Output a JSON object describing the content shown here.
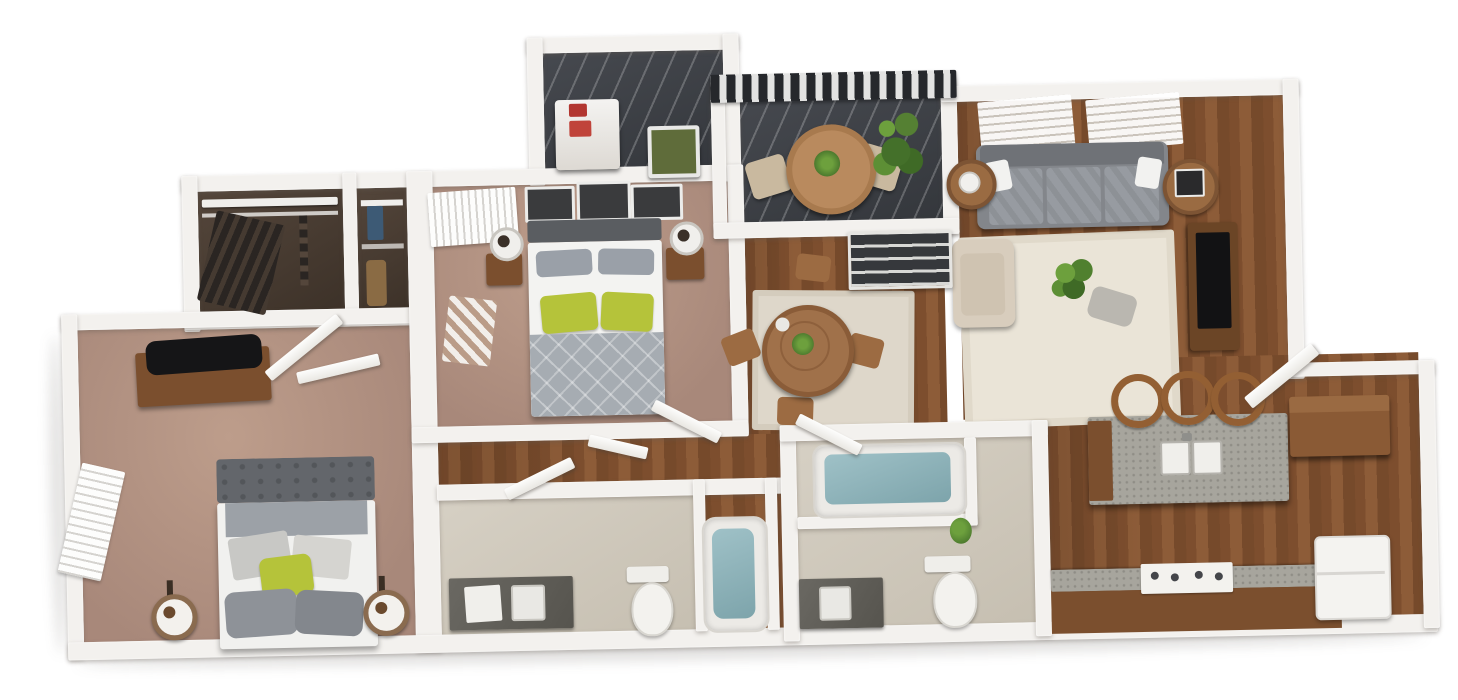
{
  "scene": {
    "kind": "3d-rendered-floor-plan",
    "description": "Top-down 3D rendering of a two-bedroom, two-bathroom apartment with balcony, open kitchen, dining and living areas",
    "background_color": "#ffffff",
    "visible_text": [],
    "bedrooms": 2,
    "bathrooms": 2
  },
  "palette": {
    "wall_white": "#f3f1ee",
    "carpet_mauve": "#b3927f",
    "wood_floor_brown": "#7f5130",
    "dark_floor_charcoal": "#3e4146",
    "bathroom_floor_beige": "#d0c9bc",
    "rug_cream": "#eae4d7",
    "sofa_gray": "#8e9196",
    "blanket_gray": "#a6acb2",
    "accent_pillow_green": "#b5c33a",
    "tub_water_teal": "#8fb3ba",
    "cabinet_brown": "#7b4f2e",
    "granite_gray": "#a7a59d",
    "railing_stripe_dark": "#26282c"
  },
  "rooms": {
    "balcony": {
      "name": "balcony",
      "floor": "dark charcoal decking",
      "furniture": [
        "striped railing",
        "round bistro table",
        "patio chair left",
        "patio chair right",
        "potted plant",
        "table plant"
      ]
    },
    "laundry_closet": {
      "name": "laundry closet",
      "floor": "dark charcoal",
      "furniture": [
        "washer-dryer unit",
        "red detergent bottles",
        "framed wall art"
      ]
    },
    "living_room": {
      "name": "living room",
      "floor": "hardwood",
      "furniture": [
        "gray sofa",
        "white throw pillows",
        "round side table with lamp",
        "round side table with dark lamp",
        "tv console",
        "flat screen tv",
        "cream area rug",
        "beige armchair",
        "potted centerpiece plant",
        "gray throw"
      ]
    },
    "dining_area": {
      "name": "dining area",
      "floor": "hardwood",
      "furniture": [
        "round dining table",
        "dining chair x4",
        "centerpiece plant",
        "area rug",
        "pantry shelves"
      ]
    },
    "master_bedroom": {
      "name": "master bedroom",
      "floor": "mauve carpet",
      "furniture": [
        "queen bed with green accent pillows",
        "nightstand left",
        "nightstand right",
        "table lamp left",
        "table lamp right",
        "three wall frames",
        "window blinds",
        "striped bench"
      ]
    },
    "walk_in_closet": {
      "name": "walk-in closet",
      "floor": "dark",
      "furniture": [
        "wire shelving",
        "hanging clothes"
      ]
    },
    "utility_closet": {
      "name": "utility closet",
      "floor": "dark",
      "furniture": [
        "storage shelves",
        "stored items"
      ]
    },
    "bedroom_2": {
      "name": "bedroom 2",
      "floor": "mauve carpet",
      "furniture": [
        "bed with tufted headboard",
        "green accent pillow",
        "candle lantern left",
        "candle lantern right",
        "tv console",
        "flat screen tv",
        "window blinds",
        "open door panels"
      ]
    },
    "bathroom_1": {
      "name": "bathroom 1",
      "floor": "beige tile",
      "furniture": [
        "granite vanity with sink",
        "towel",
        "toilet",
        "bathtub"
      ]
    },
    "bathroom_2": {
      "name": "bathroom 2",
      "floor": "beige tile",
      "furniture": [
        "granite vanity with sink",
        "toilet",
        "bathtub in alcove",
        "plant"
      ]
    },
    "kitchen": {
      "name": "kitchen",
      "floor": "hardwood",
      "furniture": [
        "granite island with double sink",
        "bar stool x3",
        "brown cabinet",
        "granite counter with range",
        "refrigerator",
        "entry door"
      ]
    },
    "hallway": {
      "name": "hallway",
      "floor": "hardwood",
      "furniture": [
        "open interior doors"
      ]
    }
  }
}
